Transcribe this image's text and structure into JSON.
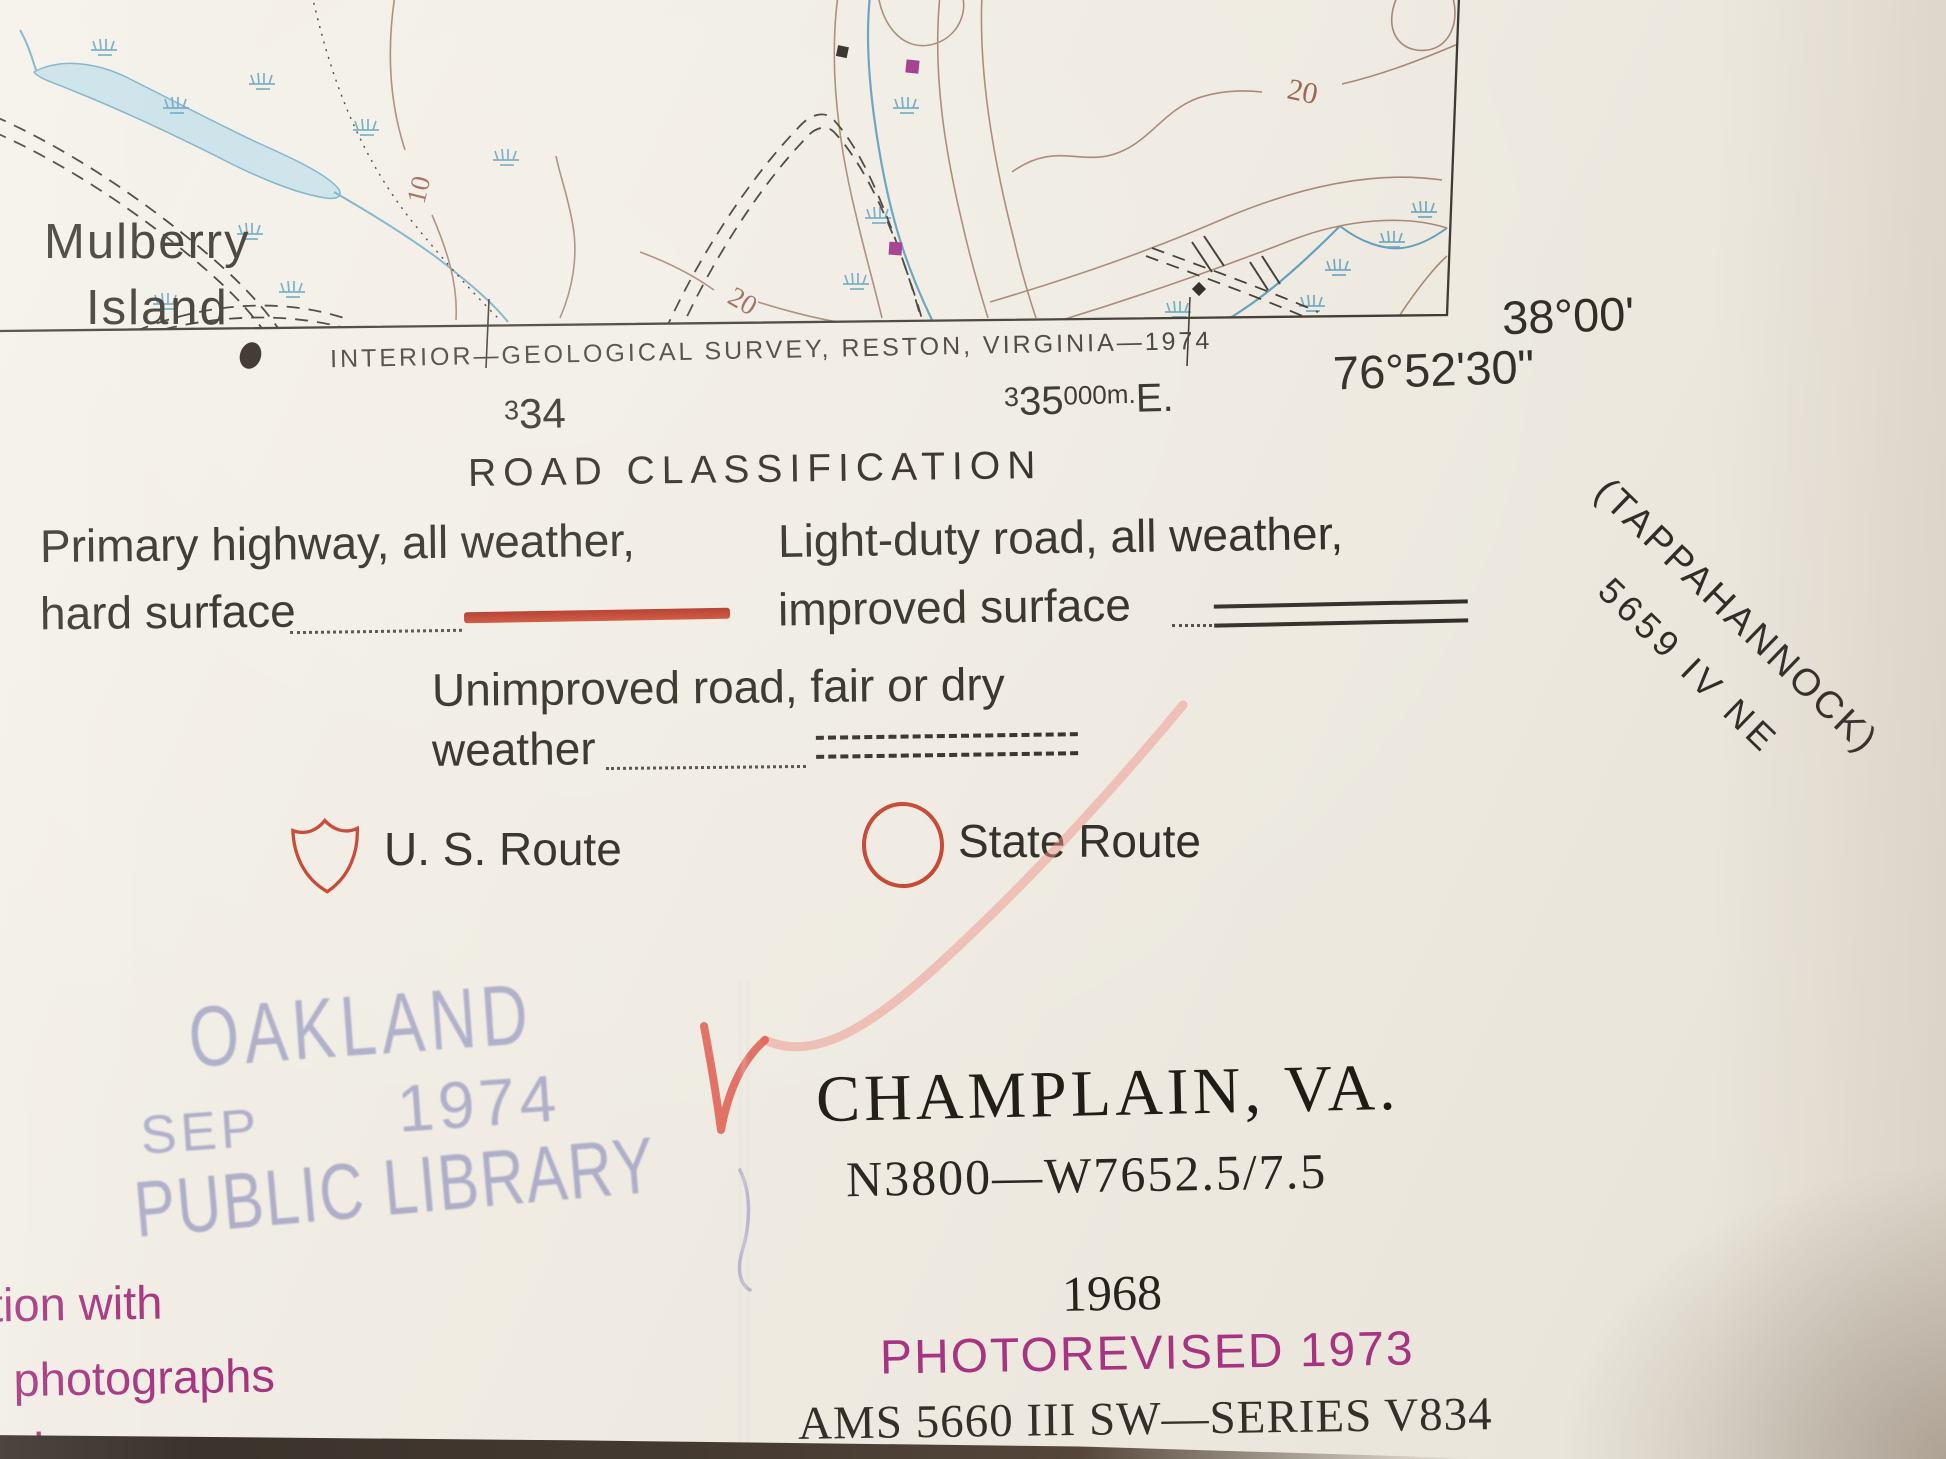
{
  "map_strip": {
    "place_label": {
      "line1": "Mulberry",
      "line2": "Island"
    },
    "contour_labels": {
      "left": "10",
      "bottom": "20",
      "right": "20"
    }
  },
  "margin": {
    "credit_line": "INTERIOR—GEOLOGICAL SURVEY, RESTON, VIRGINIA—1974",
    "grid_label_west": {
      "sup": "3",
      "main": "34"
    },
    "grid_label_east": {
      "sup": "3",
      "main": "35",
      "exp": "000m.",
      "suffix": "E."
    },
    "latitude": "38°00'",
    "longitude": "76°52'30\"",
    "adjoining_sheet": {
      "line1": "(TAPPAHANNOCK)",
      "line2": "5659 IV NE"
    }
  },
  "legend": {
    "title": "ROAD CLASSIFICATION",
    "primary_line1": "Primary highway, all weather,",
    "primary_line2": "hard surface",
    "light_duty_line1": "Light-duty road, all weather,",
    "light_duty_line2": "improved surface",
    "unimproved_line1": "Unimproved road, fair or dry",
    "unimproved_line2": "weather",
    "us_route_label": "U. S. Route",
    "state_route_label": "State Route"
  },
  "stamp": {
    "line1": "OAKLAND",
    "line2_left": "SEP",
    "line2_right": "1974",
    "line3": "PUBLIC LIBRARY"
  },
  "title_block": {
    "quad_name": "CHAMPLAIN, VA.",
    "location_code": "N3800—W7652.5/7.5",
    "year": "1968",
    "photorevised": "PHOTOREVISED 1973",
    "series": "AMS 5660 III SW—SERIES V834"
  },
  "left_fragment": {
    "line1": "tion with",
    "line2": "l photographs",
    "line3": "ed"
  },
  "colors": {
    "road_red": "#c4402c",
    "magenta": "#a63480",
    "stamp_purple": "#7e81b6",
    "contour_brown": "#a5836f",
    "water_blue": "#74adc4",
    "check_red": "#dd4f44"
  }
}
